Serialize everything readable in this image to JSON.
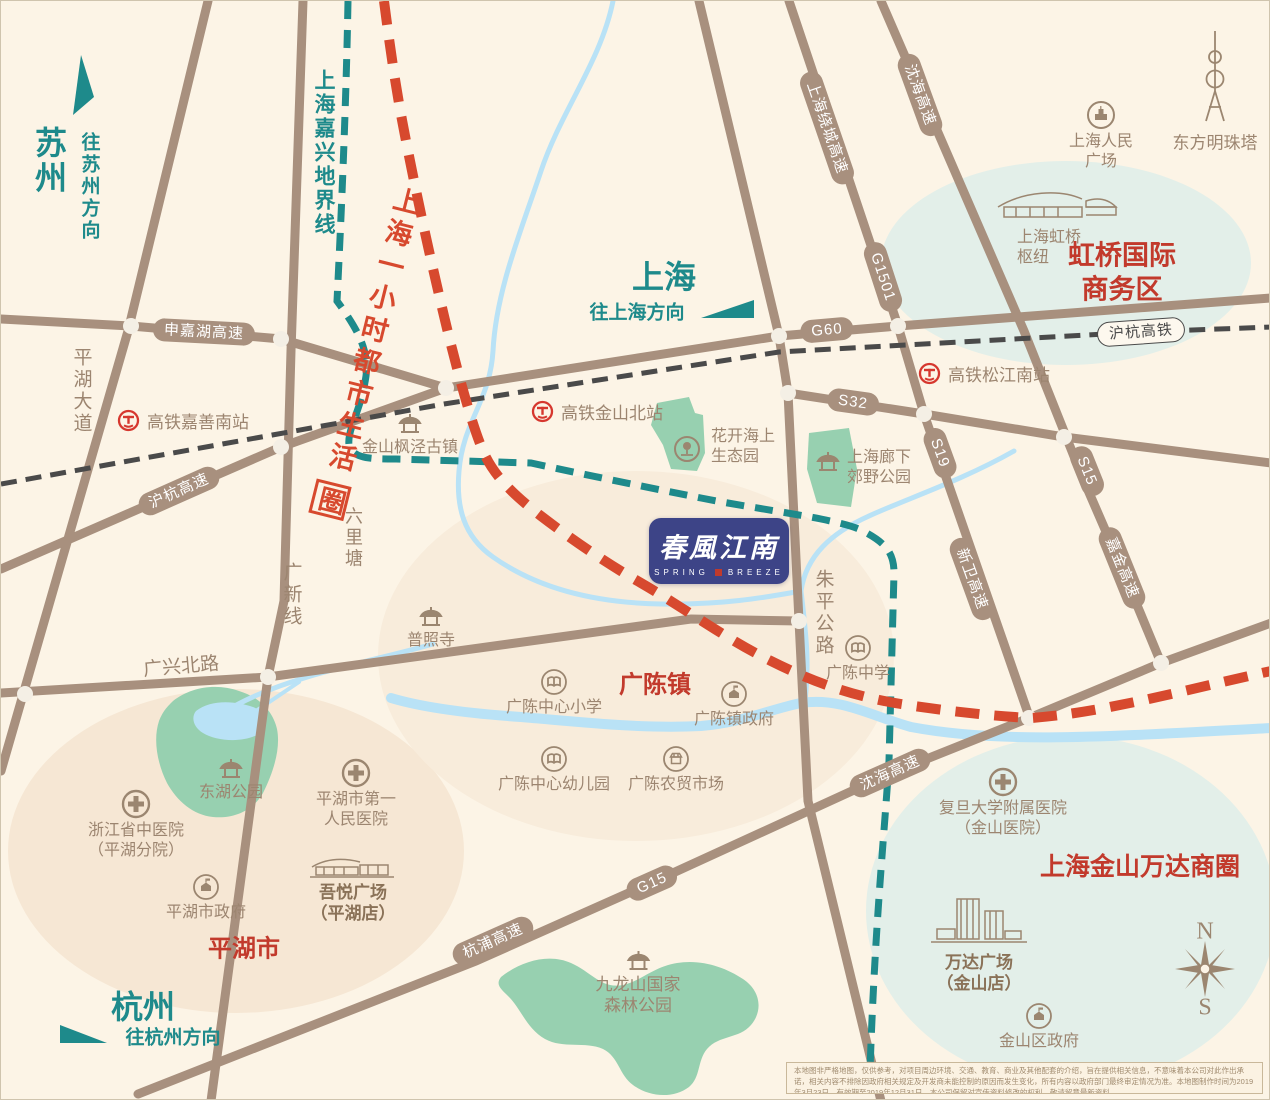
{
  "colors": {
    "teal": "#1e8a8b",
    "red_line": "#d7492e",
    "red_text": "#c23a2c",
    "road": "#a8907e",
    "river": "#b9e2f6",
    "park": "#97d0b0",
    "navy": "#3d4487",
    "cream": "#fcf4e6"
  },
  "cities": {
    "suzhou": {
      "name": "苏州",
      "direction": "往苏州方向"
    },
    "shanghai": {
      "name": "上海",
      "direction": "往上海方向"
    },
    "hangzhou": {
      "name": "杭州",
      "direction": "往杭州方向"
    }
  },
  "boundary_label": "上海嘉兴地界线",
  "slogan": {
    "text": "上海一小时都市生活",
    "stamp": "圈"
  },
  "roads": {
    "shenjiahu": "申嘉湖高速",
    "huhang_exp": "沪杭高速",
    "raocheng": "上海绕城高速",
    "g60": "G60",
    "g1501": "G1501",
    "s32": "S32",
    "s19": "S19",
    "s15": "S15",
    "xinwei": "新卫高速",
    "jiajin": "嘉金高速",
    "shenhai": "沈海高速",
    "hangpu": "杭浦高速",
    "g15": "G15",
    "huhang_rail": "沪杭高铁",
    "pinghu_ave": "平湖大道",
    "guangxin": "广新线",
    "zhuping": "朱平公路",
    "guangxing": "广兴北路",
    "liulitang": "六里塘"
  },
  "stations": {
    "jiashan_south": "高铁嘉善南站",
    "jinshan_north": "高铁金山北站",
    "songjiang_south": "高铁松江南站"
  },
  "pois": {
    "fengjing": {
      "label": "金山枫泾古镇"
    },
    "puzhaosi": {
      "label": "普照寺"
    },
    "huakai": {
      "l1": "花开海上",
      "l2": "生态园"
    },
    "langxia": {
      "l1": "上海廊下",
      "l2": "郊野公园"
    },
    "gc_middle": {
      "label": "广陈中学"
    },
    "gc_primary": {
      "label": "广陈中心小学"
    },
    "gc_gov": {
      "label": "广陈镇政府"
    },
    "gc_kinder": {
      "label": "广陈中心幼儿园"
    },
    "gc_market": {
      "label": "广陈农贸市场"
    },
    "donghu": {
      "label": "东湖公园"
    },
    "zj_hospital": {
      "l1": "浙江省中医院",
      "l2": "（平湖分院）"
    },
    "ph_hospital": {
      "l1": "平湖市第一",
      "l2": "人民医院"
    },
    "ph_gov": {
      "label": "平湖市政府"
    },
    "wuyue": {
      "l1": "吾悦广场",
      "l2": "（平湖店）"
    },
    "jiulongshan": {
      "l1": "九龙山国家",
      "l2": "森林公园"
    },
    "fudan": {
      "l1": "复旦大学附属医院",
      "l2": "（金山医院）"
    },
    "wanda": {
      "l1": "万达广场",
      "l2": "（金山店）"
    },
    "js_gov": {
      "label": "金山区政府"
    },
    "renmin": {
      "l1": "上海人民",
      "l2": "广场"
    },
    "pearl": {
      "label": "东方明珠塔"
    },
    "hongqiao_hub": {
      "l1": "上海虹桥",
      "l2": "枢纽"
    }
  },
  "zones": {
    "hongqiao_cbd": {
      "l1": "虹桥国际",
      "l2": "商务区"
    },
    "wanda_circle": "上海金山万达商圈",
    "pinghu_city": "平湖市",
    "guangchen": "广陈镇"
  },
  "logo": {
    "cn": "春風江南",
    "en1": "SPRING",
    "en2": "BREEZE"
  },
  "compass": {
    "n": "N",
    "s": "S"
  },
  "disclaimer": "本地图非严格地图，仅供参考，对项目周边环境、交通、教育、商业及其他配套的介绍，旨在提供相关信息，不意味着本公司对此作出承诺，相关内容不排除因政府相关规定及开发商未能控制的原因而发生变化，所有内容以政府部门最终审定情况为准。本地图制作时间为2019年3月23日，有效期至2019年12月31日，本公司保留对宣传资料修改的权利，敬请留意最新资料。"
}
